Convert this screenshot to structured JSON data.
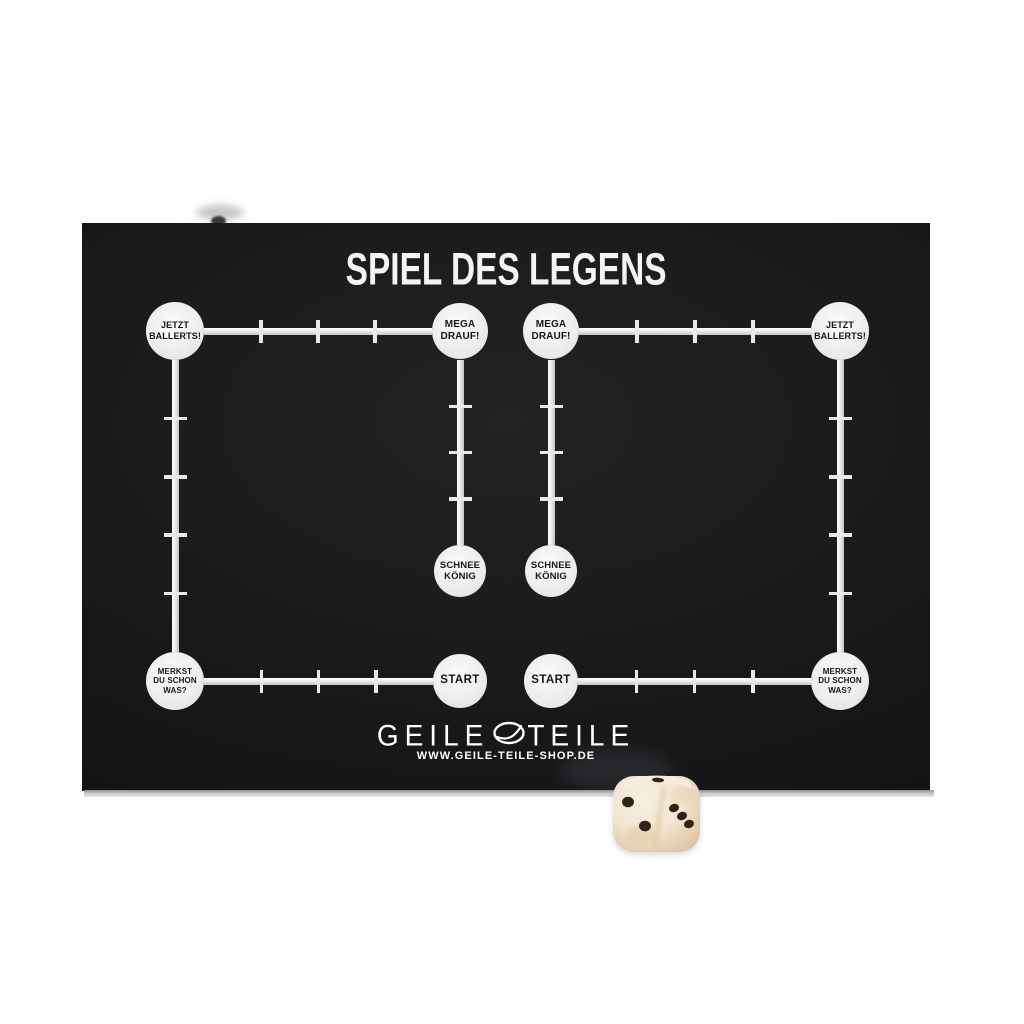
{
  "board": {
    "title": "SPIEL DES LEGENS",
    "background": "#19191b",
    "edge_color": "#c6c6c6",
    "track_color": "#ececec"
  },
  "track_nodes": {
    "jetzt_ballerts": "JETZT BALLERTS!",
    "mega_drauf": "MEGA DRAUF!",
    "schnee_koenig": "SCHNEE KÖNIG",
    "start": "START",
    "merkst_du": "MERKST DU SCHON WAS?"
  },
  "track_layout": {
    "halves": 2,
    "ticks_top": 3,
    "ticks_side": 4,
    "ticks_middle": 3,
    "ticks_bottom": 3
  },
  "brand": {
    "logo_left": "GEILE",
    "logo_right": "TEILE",
    "website": "WWW.GEILE-TEILE-SHOP.DE"
  },
  "dice": {
    "material_color": "#f1e5d1",
    "pip_color": "#2e2519",
    "front_face_pips": 2,
    "right_face_pips": 3,
    "top_face_pips": 1
  }
}
